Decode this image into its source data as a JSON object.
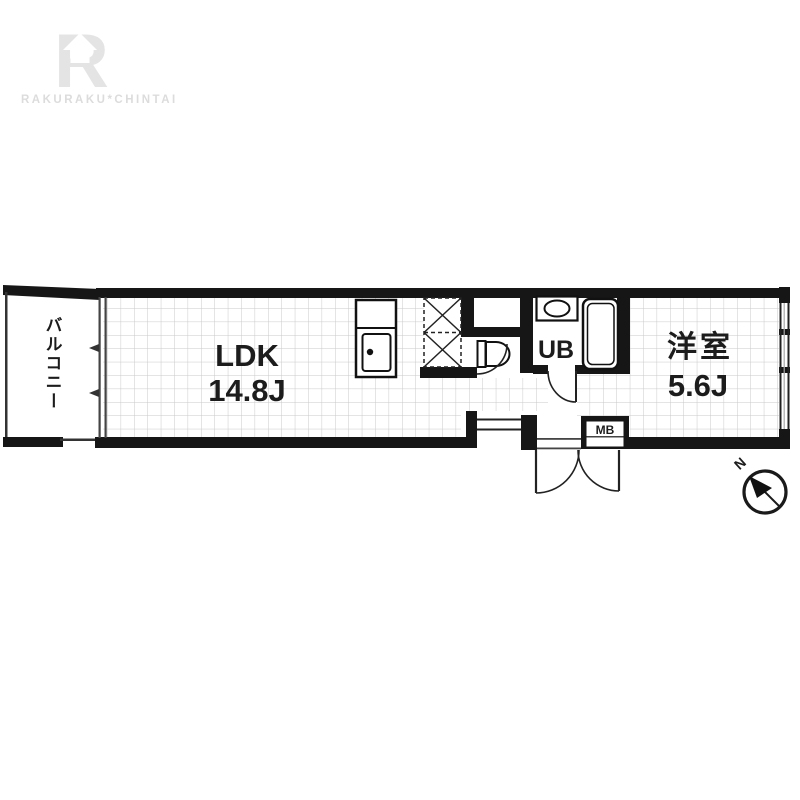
{
  "logo": {
    "letter": "R",
    "brand": "RAKURAKU*CHINTAI"
  },
  "floorplan": {
    "balcony": {
      "label": "バルコニー"
    },
    "ldk": {
      "name": "LDK",
      "size": "14.8J"
    },
    "western_room": {
      "name": "洋室",
      "size": "5.6J"
    },
    "unit_bath": {
      "label": "UB"
    },
    "meter_box": {
      "label": "MB"
    },
    "compass": {
      "north_label": "N"
    }
  },
  "colors": {
    "wall": "#161616",
    "grid_line": "#c9c9c9",
    "logo_gray": "#e4e4e4",
    "background": "#ffffff"
  }
}
